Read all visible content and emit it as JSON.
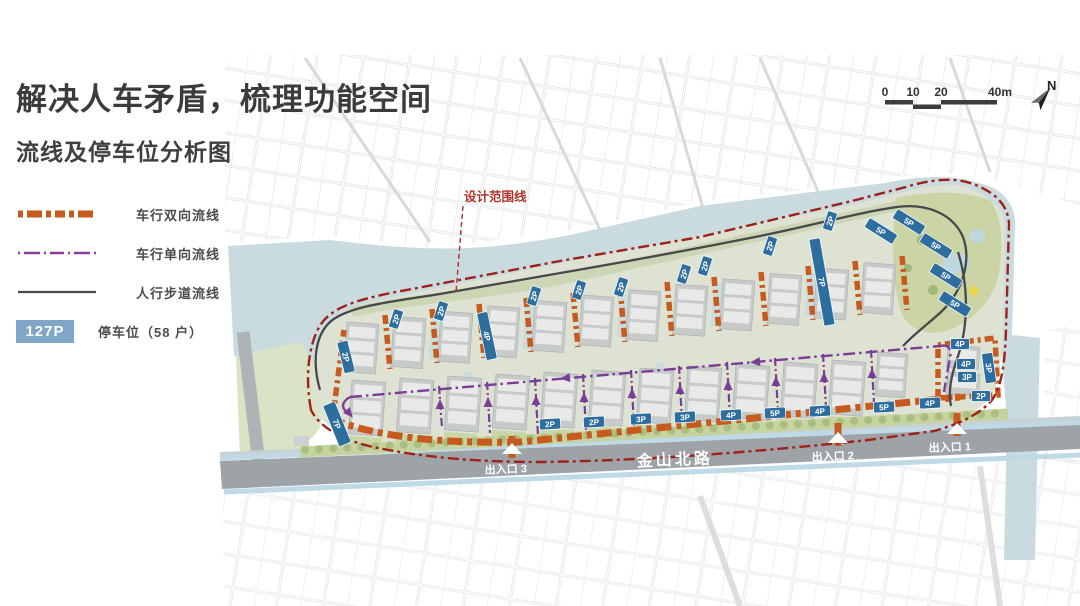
{
  "slide": {
    "title": "解决人车矛盾，梳理功能空间",
    "subtitle": "流线及停车位分析图"
  },
  "legend": {
    "items": [
      {
        "label": "车行双向流线",
        "type": "two-way-vehicle",
        "color": "#c75a1e"
      },
      {
        "label": "车行单向流线",
        "type": "one-way-vehicle",
        "color": "#8b3f9b"
      },
      {
        "label": "人行步道流线",
        "type": "pedestrian",
        "color": "#46484c"
      },
      {
        "label": "停车位（58 户）",
        "type": "parking",
        "badge": "127P",
        "color": "#7fa6c6"
      }
    ]
  },
  "scalebar": {
    "labels": [
      "0",
      "10",
      "20",
      "40m"
    ],
    "north_label": "N"
  },
  "map": {
    "boundary_label": "设计范围线",
    "road_name": "金山北路",
    "entrances": [
      {
        "label": "出入口 1"
      },
      {
        "label": "出入口 2"
      },
      {
        "label": "出入口 3"
      }
    ],
    "parking_tags": [
      {
        "label": "2P",
        "x": 346,
        "y": 357,
        "rot": -14,
        "w": 11,
        "h": 32
      },
      {
        "label": "4P",
        "x": 487,
        "y": 336,
        "rot": -12,
        "w": 11,
        "h": 48
      },
      {
        "label": "7P",
        "x": 822,
        "y": 282,
        "rot": -10,
        "w": 11,
        "h": 88
      },
      {
        "label": "7P",
        "x": 337,
        "y": 424,
        "rot": -22,
        "w": 13,
        "h": 44
      },
      {
        "label": "5P",
        "x": 881,
        "y": 231,
        "rot": -58,
        "w": 11,
        "h": 33
      },
      {
        "label": "5P",
        "x": 909,
        "y": 222,
        "rot": -58,
        "w": 11,
        "h": 33
      },
      {
        "label": "5P",
        "x": 936,
        "y": 246,
        "rot": -58,
        "w": 11,
        "h": 33
      },
      {
        "label": "5P",
        "x": 946,
        "y": 276,
        "rot": -58,
        "w": 11,
        "h": 33
      },
      {
        "label": "5P",
        "x": 955,
        "y": 304,
        "rot": -58,
        "w": 11,
        "h": 33
      },
      {
        "label": "3P",
        "x": 989,
        "y": 368,
        "rot": -8,
        "w": 11,
        "h": 30
      },
      {
        "label": "2P",
        "x": 396,
        "y": 319,
        "rot": -72,
        "w": 19,
        "h": 10
      },
      {
        "label": "2P",
        "x": 441,
        "y": 311,
        "rot": -72,
        "w": 19,
        "h": 10
      },
      {
        "label": "2P",
        "x": 534,
        "y": 296,
        "rot": -72,
        "w": 19,
        "h": 10
      },
      {
        "label": "2P",
        "x": 579,
        "y": 290,
        "rot": -72,
        "w": 19,
        "h": 10
      },
      {
        "label": "2P",
        "x": 621,
        "y": 287,
        "rot": -72,
        "w": 19,
        "h": 10
      },
      {
        "label": "2P",
        "x": 684,
        "y": 274,
        "rot": -72,
        "w": 19,
        "h": 10
      },
      {
        "label": "2P",
        "x": 705,
        "y": 266,
        "rot": -72,
        "w": 19,
        "h": 10
      },
      {
        "label": "2P",
        "x": 770,
        "y": 246,
        "rot": -72,
        "w": 19,
        "h": 10
      },
      {
        "label": "2P",
        "x": 830,
        "y": 221,
        "rot": -72,
        "w": 19,
        "h": 10
      },
      {
        "label": "2P",
        "x": 550,
        "y": 424,
        "rot": -3,
        "w": 21,
        "h": 11
      },
      {
        "label": "2P",
        "x": 594,
        "y": 422,
        "rot": -3,
        "w": 21,
        "h": 11
      },
      {
        "label": "3P",
        "x": 641,
        "y": 419,
        "rot": -3,
        "w": 21,
        "h": 11
      },
      {
        "label": "3P",
        "x": 685,
        "y": 417,
        "rot": -3,
        "w": 21,
        "h": 11
      },
      {
        "label": "4P",
        "x": 731,
        "y": 415,
        "rot": -3,
        "w": 21,
        "h": 11
      },
      {
        "label": "5P",
        "x": 775,
        "y": 413,
        "rot": -3,
        "w": 21,
        "h": 11
      },
      {
        "label": "4P",
        "x": 820,
        "y": 411,
        "rot": -3,
        "w": 21,
        "h": 11
      },
      {
        "label": "5P",
        "x": 884,
        "y": 407,
        "rot": -3,
        "w": 21,
        "h": 11
      },
      {
        "label": "4P",
        "x": 930,
        "y": 403,
        "rot": -3,
        "w": 21,
        "h": 11
      },
      {
        "label": "4P",
        "x": 960,
        "y": 344,
        "rot": 0,
        "w": 19,
        "h": 11
      },
      {
        "label": "4P",
        "x": 966,
        "y": 364,
        "rot": 0,
        "w": 19,
        "h": 11
      },
      {
        "label": "3P",
        "x": 967,
        "y": 377,
        "rot": 0,
        "w": 19,
        "h": 11
      },
      {
        "label": "2P",
        "x": 981,
        "y": 396,
        "rot": 0,
        "w": 19,
        "h": 11
      }
    ]
  },
  "colors": {
    "two_way": "#c75a1e",
    "one_way": "#8b3f9b",
    "pedestrian": "#46484c",
    "boundary": "#9e211a",
    "parking_tag": "#2d6e9e",
    "water": "#c9dbdf",
    "road": "#9da3a6"
  }
}
